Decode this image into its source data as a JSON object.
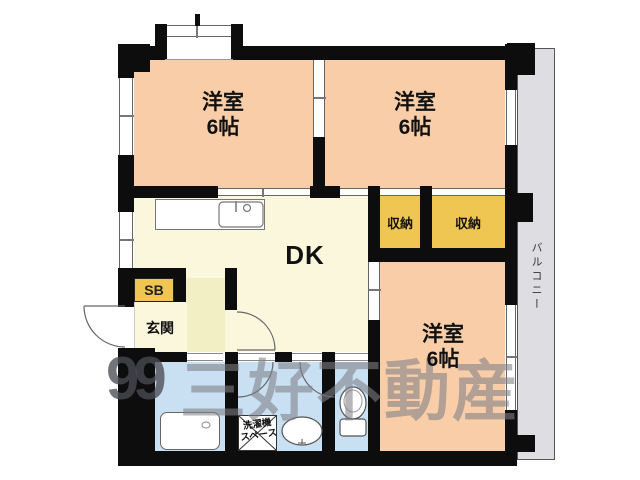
{
  "floorplan": {
    "rooms": {
      "bedroom1": {
        "name": "洋室",
        "size": "6帖"
      },
      "bedroom2": {
        "name": "洋室",
        "size": "6帖"
      },
      "bedroom3": {
        "name": "洋室",
        "size": "6帖"
      },
      "dining_kitchen": {
        "name": "DK"
      },
      "closet_left": {
        "name": "収納"
      },
      "closet_right": {
        "name": "収納"
      },
      "shoe_box": {
        "name": "SB"
      },
      "entrance": {
        "name": "玄関"
      },
      "balcony": {
        "name": "バルコニー"
      },
      "laundry_space": {
        "line1": "洗濯機",
        "line2": "スペース"
      }
    },
    "watermark": {
      "logo_text": "99",
      "company_name": "三好不動産"
    },
    "colors": {
      "bedroom_fill": "#f8cda7",
      "closet_fill": "#f0c652",
      "dk_fill": "#faf7dd",
      "hallway_fill": "#f3efc4",
      "wet_area_fill": "#c8e0f2",
      "balcony_fill": "#dedde2",
      "wall": "#0d0d0d"
    }
  }
}
